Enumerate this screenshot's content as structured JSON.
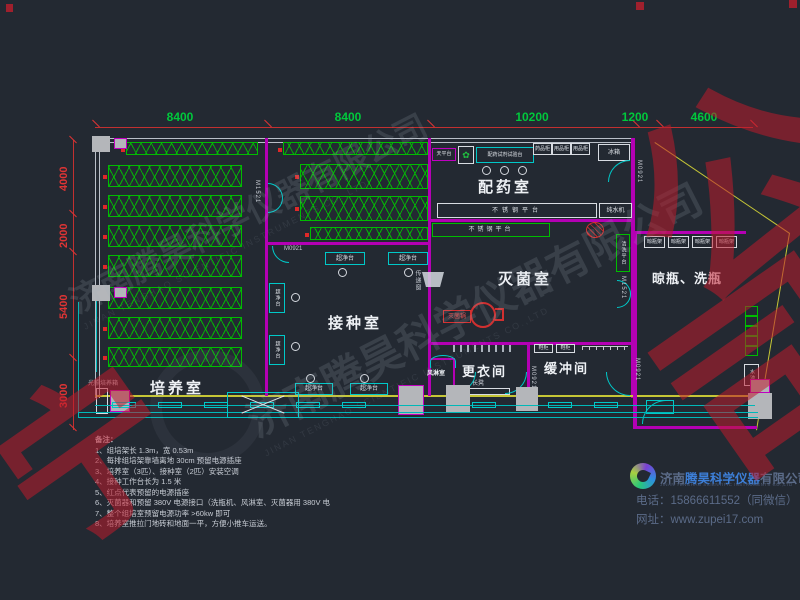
{
  "dims": {
    "top": [
      "8400",
      "8400",
      "10200",
      "1200",
      "4600"
    ],
    "left": [
      "4000",
      "2000",
      "5400",
      "3000"
    ]
  },
  "rooms": {
    "culture": "培养室",
    "inoculation": "接种室",
    "dispensing": "配药室",
    "sterilization": "灭菌室",
    "changing": "更衣间",
    "buffer": "缓冲间",
    "airshower": "风淋室",
    "bottle": "晾瓶、洗瓶"
  },
  "equip": {
    "balance": "天平台",
    "dispense_bench": "配药试剂试验台",
    "cab1": "药品柜",
    "cab2": "用品柜",
    "cab3": "用品柜",
    "fridge": "冰箱",
    "ss_platform": "不锈钢平台",
    "water_machine": "纯水机",
    "transfer_window": "传递窗",
    "sterilizer": "灭菌锅",
    "wash_platform": "清洗平台",
    "bottle_rack": "晾瓶架",
    "clean_bench": "超净台",
    "incubator": "光照培养箱",
    "bench_seat": "长凳",
    "shoe_cab": "鞋柜",
    "sink": "水池"
  },
  "icons": {
    "plant": "✿"
  },
  "doors": {
    "m0921": "M0921",
    "m1521": "M1521"
  },
  "notes": {
    "title": "备注：",
    "items": [
      "1、组培架长 1.3m，宽 0.53m",
      "2、每排组培架靠墙离地 30cm 预留电源插座",
      "3、培养室（3匹）、接种室（2匹）安装空调",
      "4、接种工作台长为 1.5 米",
      "5、红点代表预留的电源插座",
      "6、灭菌器和预留 380V 电源接口（洗瓶机、风淋室、灭菌器用 380V 电",
      "7、整个组培室预留电源功率 >60kw 即可",
      "8、培养室推拉门地砖和地面一平，方便小推车运送。"
    ]
  },
  "company": {
    "cn_prefix": "济南",
    "cn_mid": "腾昊科学仪器",
    "cn_suffix": "有限公司",
    "en": "JINAN TENGHAO SCIENTIFIC INSTRUMENTS CO.,LTD",
    "phone_label": "电话：",
    "phone": "15866611552（同微信）",
    "web_label": "网址：",
    "website": "www.zupei17.com"
  },
  "watermark": {
    "cn": "济南腾昊科学仪器有限公司",
    "en": "JINAN TENGHAO SCIENTIFIC INSTRUMENTS CO.,LTD",
    "red_a": "宁",
    "red_b": "公",
    "red_c": "司"
  }
}
